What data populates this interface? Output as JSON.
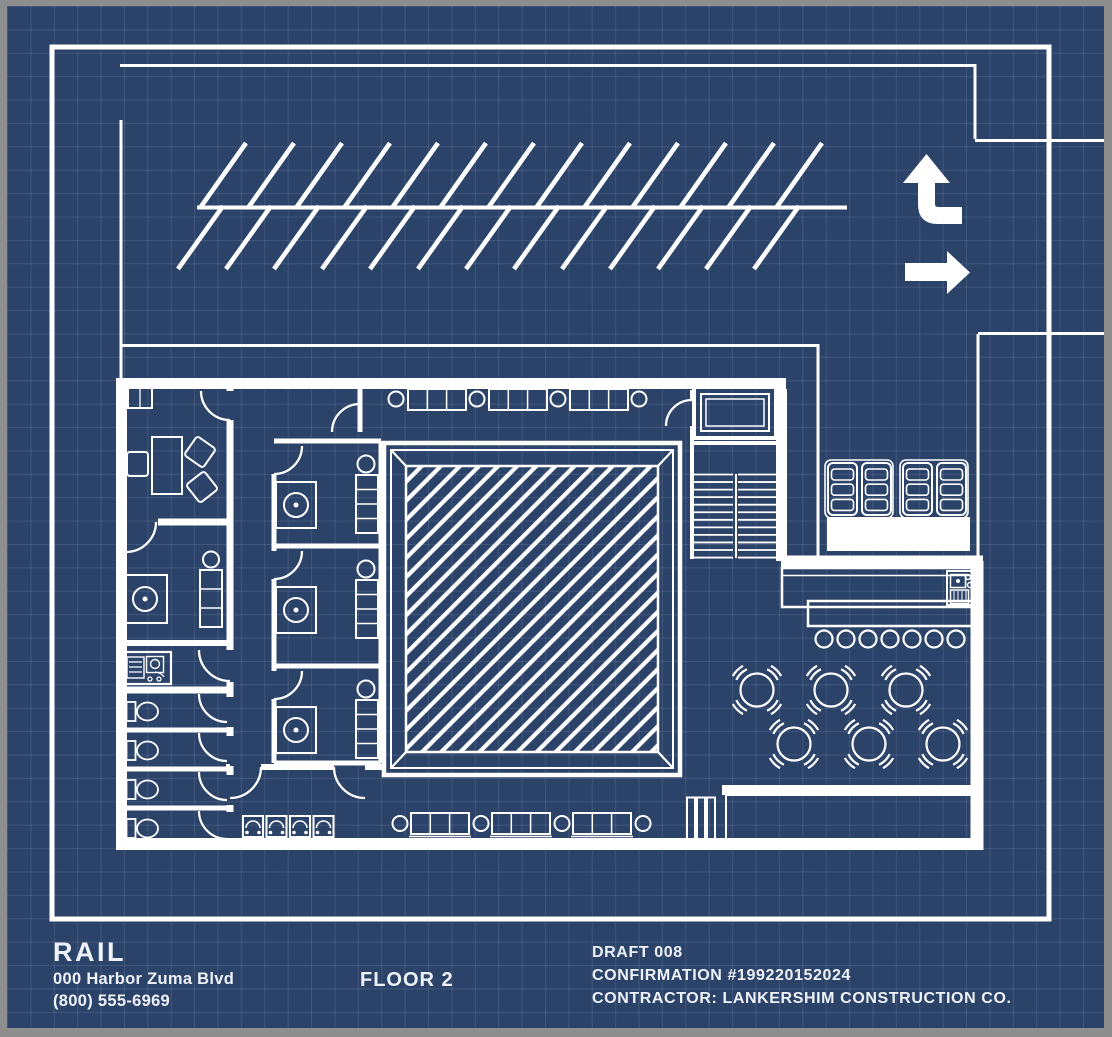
{
  "colors": {
    "paper": "#2b4269",
    "ink": "#ffffff",
    "frame": "#8e8e8e",
    "grid_line": "rgba(173,192,220,0.16)",
    "text": "#eef2f8"
  },
  "title_block": {
    "client_name": "RAIL",
    "address_line": "000 Harbor Zuma Blvd",
    "phone_line": "(800) 555-6969",
    "floor_label": "FLOOR 2",
    "draft_label": "DRAFT 008",
    "confirmation_label": "CONFIRMATION #199220152024",
    "contractor_label": "CONTRACTOR: LANKERSHIM CONSTRUCTION CO."
  },
  "site": {
    "icons": [
      {
        "name": "turn-up-arrow-icon"
      },
      {
        "name": "right-arrow-icon"
      }
    ],
    "parking_stalls_top_row": 13,
    "parking_stalls_bottom_row": 13
  },
  "plan": {
    "vip_rooms": 3,
    "toilet_stalls": 4,
    "restroom_sinks": 4,
    "dining_tables": 6,
    "chairs_per_table": 4,
    "bar_stools": 7,
    "stair_treads_per_flight": 12,
    "dumpster_units": 4,
    "turnstile_rails": 3,
    "booth_sofas_top_row": 3,
    "booth_tables_top_row": 4,
    "booth_sofas_bottom_row": 3,
    "booth_tables_bottom_row": 4
  }
}
